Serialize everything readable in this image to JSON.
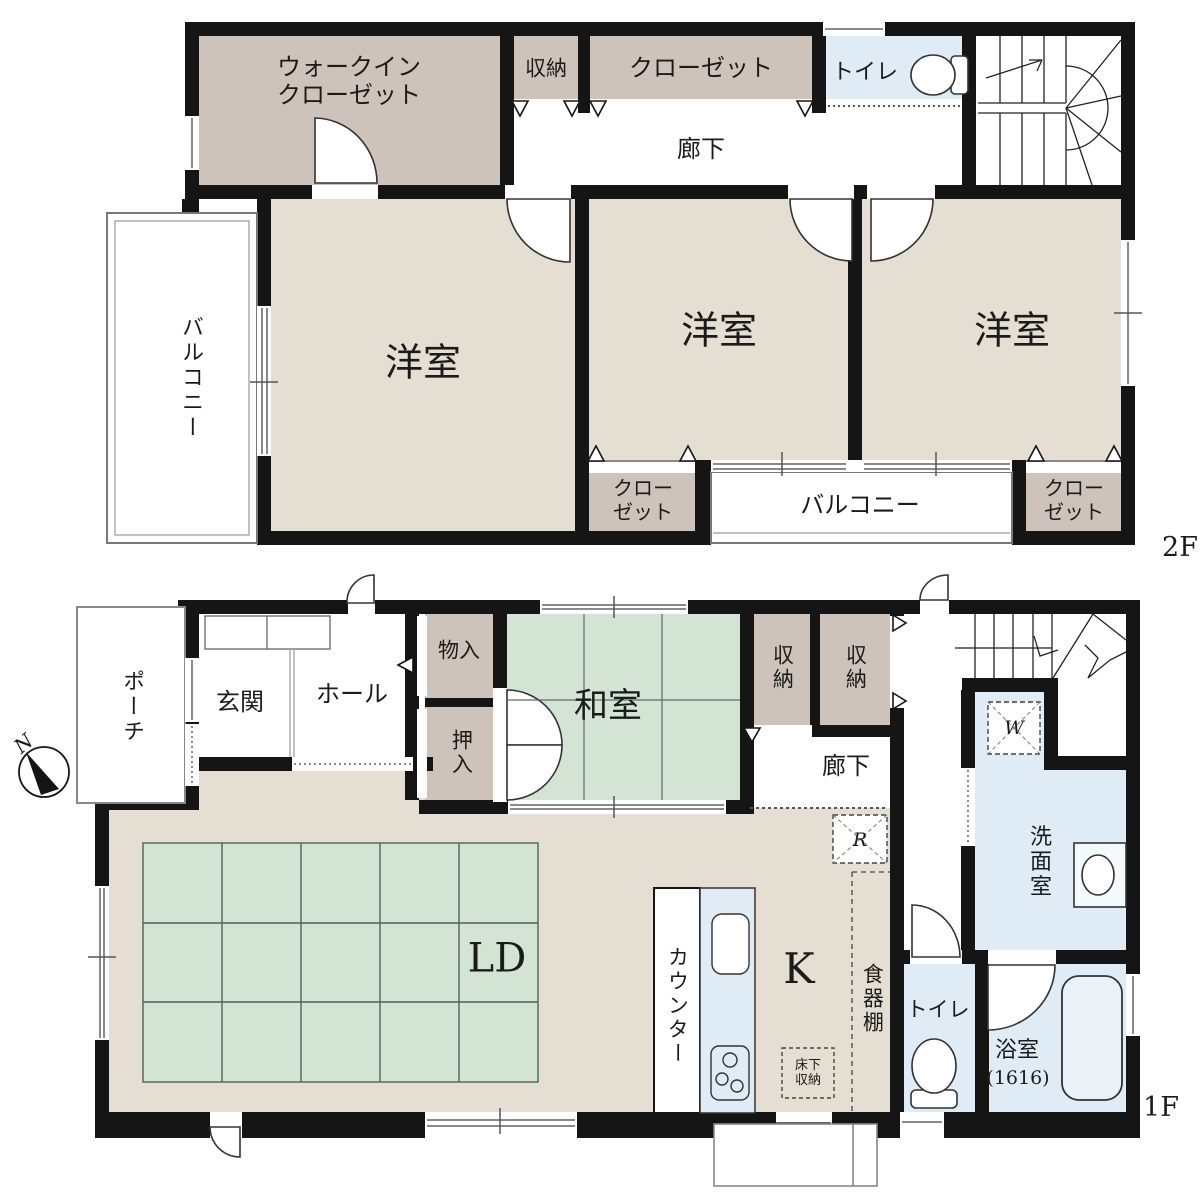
{
  "title": "2階建て住宅 間取り図",
  "colors": {
    "wall": "#151515",
    "room_beige": "#e4dfd2",
    "closet_tan": "#cdc3ba",
    "tatami_green": "#d3e4d5",
    "wet_blue": "#dfecf6",
    "line": "#333333",
    "rug_line": "#50605a"
  },
  "floor2": {
    "floor_label": "2F",
    "walk_in_closet_line1": "ウォークイン",
    "walk_in_closet_line2": "クローゼット",
    "storage": "収納",
    "closet": "クローゼット",
    "toilet": "トイレ",
    "corridor": "廊下",
    "balcony_left": "バルコニー",
    "bedroom1": "洋室",
    "bedroom2": "洋室",
    "bedroom3": "洋室",
    "closet_bl_line1": "クロー",
    "closet_bl_line2": "ゼット",
    "balcony_bottom": "バルコニー",
    "closet_br_line1": "クロー",
    "closet_br_line2": "ゼット"
  },
  "floor1": {
    "floor_label": "1F",
    "compass_n": "N",
    "porch": "ポーチ",
    "entrance": "玄関",
    "hall": "ホール",
    "storage_small": "物入",
    "oshiire": "押入",
    "washitsu": "和室",
    "storage_a": "収納",
    "storage_b": "収納",
    "corridor": "廊下",
    "washroom": "洗面室",
    "washer_mark": "W",
    "fridge_mark": "R",
    "living_dining": "LD",
    "counter": "カウンター",
    "kitchen": "K",
    "cupboard": "食器棚",
    "underfloor_line1": "床下",
    "underfloor_line2": "収納",
    "toilet": "トイレ",
    "bath": "浴室",
    "bath_size": "(1616)"
  }
}
